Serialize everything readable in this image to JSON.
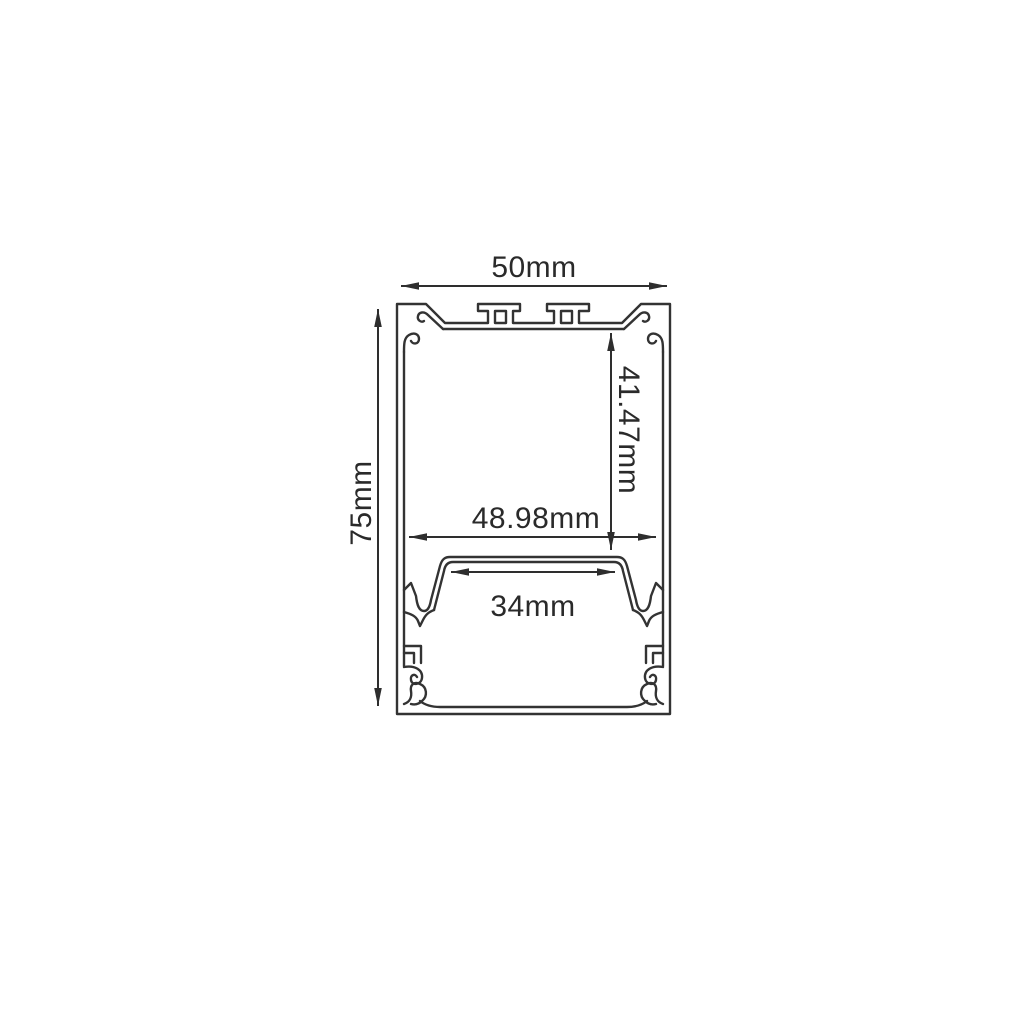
{
  "figure": {
    "kind": "technical-cross-section-drawing",
    "line_color": "#333333",
    "background_color": "#ffffff",
    "dimensions": {
      "overall_width": {
        "label": "50mm"
      },
      "overall_height": {
        "label": "75mm"
      },
      "cavity_depth": {
        "label": "41.47mm"
      },
      "cavity_width": {
        "label": "48.98mm"
      },
      "platform_width": {
        "label": "34mm"
      }
    }
  }
}
